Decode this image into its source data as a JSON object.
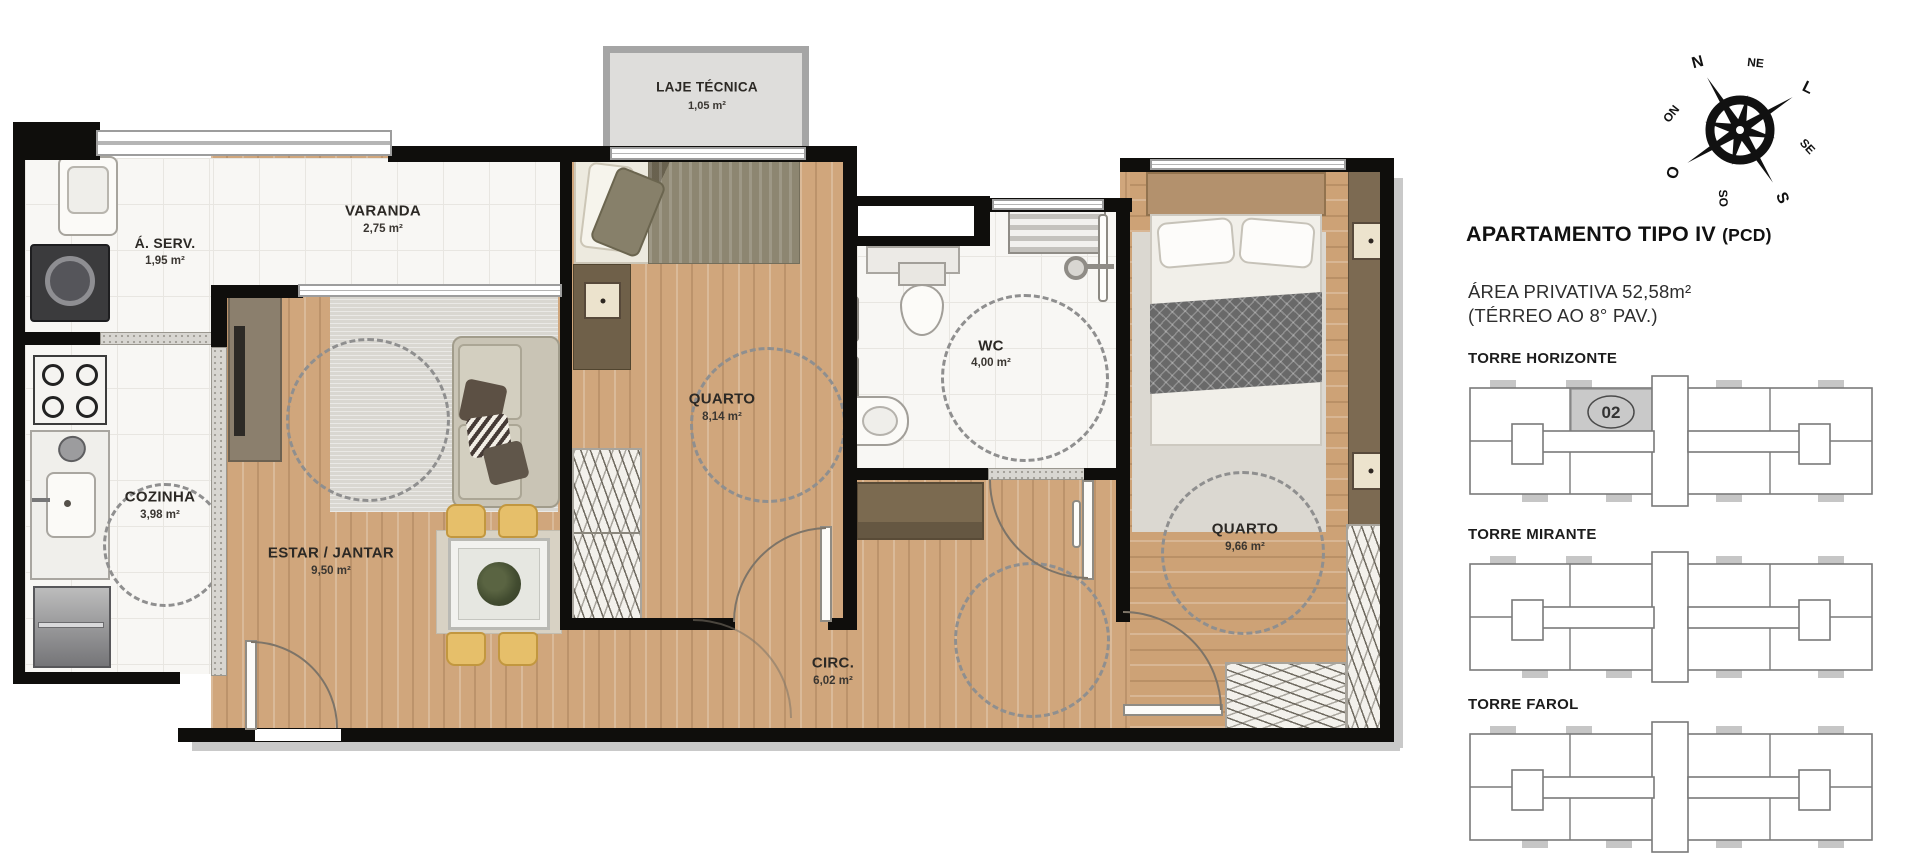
{
  "plan": {
    "rooms": {
      "laje": {
        "name": "LAJE TÉCNICA",
        "area": "1,05 m²"
      },
      "aserv": {
        "name": "Á. SERV.",
        "area": "1,95 m²"
      },
      "varanda": {
        "name": "VARANDA",
        "area": "2,75 m²"
      },
      "cozinha": {
        "name": "COZINHA",
        "area": "3,98 m²"
      },
      "estar": {
        "name": "ESTAR / JANTAR",
        "area": "9,50 m²"
      },
      "quarto1": {
        "name": "QUARTO",
        "area": "8,14 m²"
      },
      "wc": {
        "name": "WC",
        "area": "4,00 m²"
      },
      "quarto2": {
        "name": "QUARTO",
        "area": "9,66 m²"
      },
      "circ": {
        "name": "CIRC.",
        "area": "6,02 m²"
      }
    }
  },
  "info": {
    "title": "APARTAMENTO TIPO IV",
    "title_suffix": "(PCD)",
    "private_area": "ÁREA PRIVATIVA 52,58m²",
    "floors": "(TÉRREO AO 8° PAV.)"
  },
  "compass": {
    "points": [
      "N",
      "NE",
      "L",
      "SE",
      "S",
      "SO",
      "O",
      "NO"
    ],
    "rotation_deg": -32
  },
  "towers": [
    {
      "name": "TORRE HORIZONTE",
      "highlighted_unit": "02"
    },
    {
      "name": "TORRE MIRANTE",
      "highlighted_unit": null
    },
    {
      "name": "TORRE FAROL",
      "highlighted_unit": null
    }
  ],
  "colors": {
    "wall": "#0f0e0c",
    "wood": "#d0a67c",
    "tile": "#f8f7f4",
    "unit_highlight": "#c9c9c9"
  }
}
